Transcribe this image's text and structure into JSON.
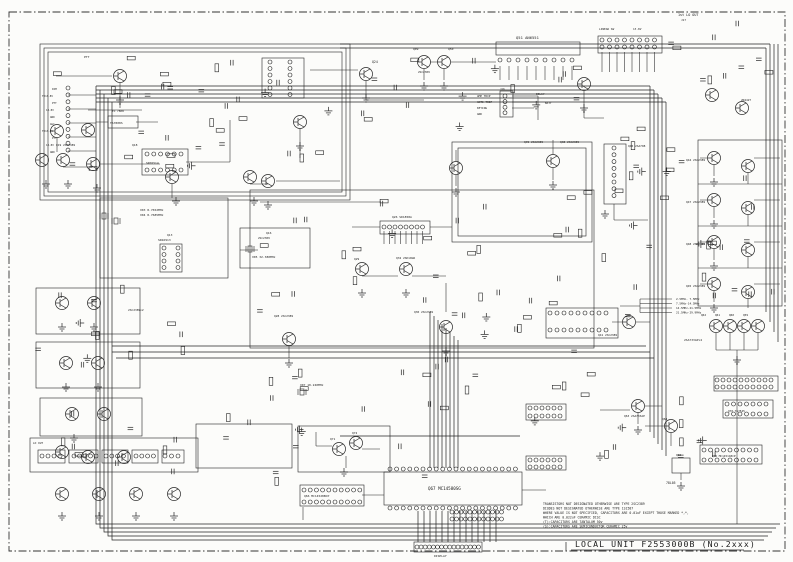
{
  "sheet": {
    "title": "LOCAL UNIT F2553000B (No.2xxx)"
  },
  "notes": {
    "lines": [
      "TRANSISTORS NOT DESIGNATED OTHERWISE ARE TYPE 2SC2389",
      "DIODES NOT DESIGNATED OTHERWISE ARE TYPE 1S1587",
      "WHERE VALUE IS NOT SPECIFIED, CAPACITORS ARE 0.01uF EXCEPT THOSE MARKED *,*,",
      " WHICH ARE 0.022uF CERAMIC DISC",
      "(T):CAPACITORS ARE TANTALUM 50v",
      "(S):CAPACITORS ARE SEMICONDUCTOR CERAMIC 25v"
    ]
  },
  "labels": [
    {
      "text": "1st LO OUT",
      "x": 678,
      "y": 16,
      "s": 3.4
    },
    {
      "text": "J17",
      "x": 681,
      "y": 21,
      "s": 2.8
    },
    {
      "text": "LINEAR SW",
      "x": 599,
      "y": 30,
      "s": 2.8
    },
    {
      "text": "13.8V",
      "x": 633,
      "y": 30,
      "s": 2.8
    },
    {
      "text": "Q51  AN6551",
      "x": 516,
      "y": 39,
      "s": 3.8
    },
    {
      "text": "Q09",
      "x": 413,
      "y": 50,
      "s": 3
    },
    {
      "text": "Q50",
      "x": 448,
      "y": 50,
      "s": 3
    },
    {
      "text": "2SC2389",
      "x": 418,
      "y": 73,
      "s": 2.8
    },
    {
      "text": "Q24",
      "x": 372,
      "y": 63,
      "s": 3.2
    },
    {
      "text": "PTT",
      "x": 84,
      "y": 58,
      "s": 3
    },
    {
      "text": "DELAY",
      "x": 536,
      "y": 95,
      "s": 2.8
    },
    {
      "text": "BATT",
      "x": 545,
      "y": 104,
      "s": 2.8
    },
    {
      "text": "J16",
      "x": 500,
      "y": 90,
      "s": 2.6
    },
    {
      "text": "AMP TRIP",
      "x": 477,
      "y": 97,
      "s": 2.8
    },
    {
      "text": "ANTI TRIP",
      "x": 477,
      "y": 103,
      "s": 2.8
    },
    {
      "text": "KEYING",
      "x": 477,
      "y": 109,
      "s": 2.8
    },
    {
      "text": "GND",
      "x": 477,
      "y": 115,
      "s": 2.8
    },
    {
      "text": "2N4427",
      "x": 741,
      "y": 101,
      "s": 2.8
    },
    {
      "text": "TO 7808",
      "x": 112,
      "y": 112,
      "s": 2.8
    },
    {
      "text": "TA7808S",
      "x": 110,
      "y": 124,
      "s": 3
    },
    {
      "text": "Q19 2SC2389",
      "x": 56,
      "y": 146,
      "s": 2.9
    },
    {
      "text": "Q18",
      "x": 132,
      "y": 146,
      "s": 3
    },
    {
      "text": "SN76514",
      "x": 146,
      "y": 164,
      "s": 3
    },
    {
      "text": "Q39 2SC2389",
      "x": 524,
      "y": 143,
      "s": 2.9
    },
    {
      "text": "Q38 2SC2389",
      "x": 560,
      "y": 143,
      "s": 2.9
    },
    {
      "text": "Q40 2SA798",
      "x": 628,
      "y": 147,
      "s": 2.9
    },
    {
      "text": "Q44 2SC2389",
      "x": 686,
      "y": 161,
      "s": 2.9
    },
    {
      "text": "Q47 2SC2389",
      "x": 686,
      "y": 203,
      "s": 2.9
    },
    {
      "text": "Q48 2SC2389",
      "x": 686,
      "y": 245,
      "s": 2.9
    },
    {
      "text": "Q45 2SC2389",
      "x": 686,
      "y": 287,
      "s": 2.9
    },
    {
      "text": "X03 8.7652MHz",
      "x": 140,
      "y": 211,
      "s": 3
    },
    {
      "text": "X04 8.7685MHz",
      "x": 140,
      "y": 216,
      "s": 3
    },
    {
      "text": "Q13",
      "x": 167,
      "y": 236,
      "s": 3
    },
    {
      "text": "SN16913",
      "x": 158,
      "y": 241,
      "s": 3
    },
    {
      "text": "Q16",
      "x": 266,
      "y": 234,
      "s": 3
    },
    {
      "text": "2SC2389",
      "x": 258,
      "y": 239,
      "s": 2.8
    },
    {
      "text": "X05 32.380MHz",
      "x": 252,
      "y": 258,
      "s": 3
    },
    {
      "text": "Q26 SD1858A",
      "x": 392,
      "y": 218,
      "s": 3
    },
    {
      "text": "Q32 2SK19GR",
      "x": 396,
      "y": 259,
      "s": 2.9
    },
    {
      "text": "Q29",
      "x": 354,
      "y": 260,
      "s": 2.9
    },
    {
      "text": "Q30 2SC2389",
      "x": 414,
      "y": 313,
      "s": 2.9
    },
    {
      "text": "Q28 2SC2389",
      "x": 274,
      "y": 317,
      "s": 2.9
    },
    {
      "text": "2SC2389×2",
      "x": 128,
      "y": 311,
      "s": 2.9
    },
    {
      "text": "Q41 2SC2389",
      "x": 598,
      "y": 336,
      "s": 2.9
    },
    {
      "text": "Q62",
      "x": 701,
      "y": 316,
      "s": 2.8
    },
    {
      "text": "Q61",
      "x": 715,
      "y": 316,
      "s": 2.8
    },
    {
      "text": "Q60",
      "x": 729,
      "y": 316,
      "s": 2.8
    },
    {
      "text": "Q59",
      "x": 743,
      "y": 316,
      "s": 2.8
    },
    {
      "text": "2SA733AP×4",
      "x": 684,
      "y": 341,
      "s": 3
    },
    {
      "text": "2.5MHz- 7.5MHz",
      "x": 676,
      "y": 300,
      "s": 2.8
    },
    {
      "text": "7.5MHz-14.5MHz",
      "x": 676,
      "y": 304.5,
      "s": 2.8
    },
    {
      "text": "14.5MHz-21.5MHz",
      "x": 676,
      "y": 309,
      "s": 2.8
    },
    {
      "text": "21.5MHz-29.9MHz",
      "x": 676,
      "y": 313.5,
      "s": 2.8
    },
    {
      "text": "X07 10.240MHz",
      "x": 300,
      "y": 386,
      "s": 3
    },
    {
      "text": "Q71",
      "x": 330,
      "y": 440,
      "s": 2.9
    },
    {
      "text": "Q72",
      "x": 352,
      "y": 434,
      "s": 2.9
    },
    {
      "text": "Q63 2SA733AP",
      "x": 624,
      "y": 417,
      "s": 2.9
    },
    {
      "text": "Q64",
      "x": 662,
      "y": 420,
      "s": 2.9
    },
    {
      "text": "Q68",
      "x": 676,
      "y": 456,
      "s": 2.8
    },
    {
      "text": "78L05",
      "x": 666,
      "y": 484,
      "s": 3.2
    },
    {
      "text": "Q65 MC14511BCP",
      "x": 712,
      "y": 457,
      "s": 2.8
    },
    {
      "text": "Q70 TA7545",
      "x": 728,
      "y": 412,
      "s": 2.8
    },
    {
      "text": "Q66 MC14528BCP",
      "x": 304,
      "y": 497,
      "s": 3
    },
    {
      "text": "Q67  MC14580SG",
      "x": 428,
      "y": 490,
      "s": 4.2
    },
    {
      "text": "DISPLAY",
      "x": 434,
      "y": 557,
      "s": 3
    },
    {
      "text": "LO OUT",
      "x": 33,
      "y": 444,
      "s": 2.8
    },
    {
      "text": "DIM",
      "x": 52,
      "y": 90,
      "s": 2.6
    },
    {
      "text": "TX13.8V",
      "x": 42,
      "y": 97,
      "s": 2.6
    },
    {
      "text": "PTT",
      "x": 52,
      "y": 104,
      "s": 2.6
    },
    {
      "text": "13.8V",
      "x": 46,
      "y": 111,
      "s": 2.6
    },
    {
      "text": "GND",
      "x": 50,
      "y": 118,
      "s": 2.6
    },
    {
      "text": "AGC",
      "x": 50,
      "y": 125,
      "s": 2.6
    },
    {
      "text": "TX13.8V",
      "x": 42,
      "y": 132,
      "s": 2.6
    },
    {
      "text": "PTT",
      "x": 52,
      "y": 139,
      "s": 2.6
    },
    {
      "text": "13.8V",
      "x": 46,
      "y": 146,
      "s": 2.6
    },
    {
      "text": "GND",
      "x": 50,
      "y": 153,
      "s": 2.6
    }
  ]
}
